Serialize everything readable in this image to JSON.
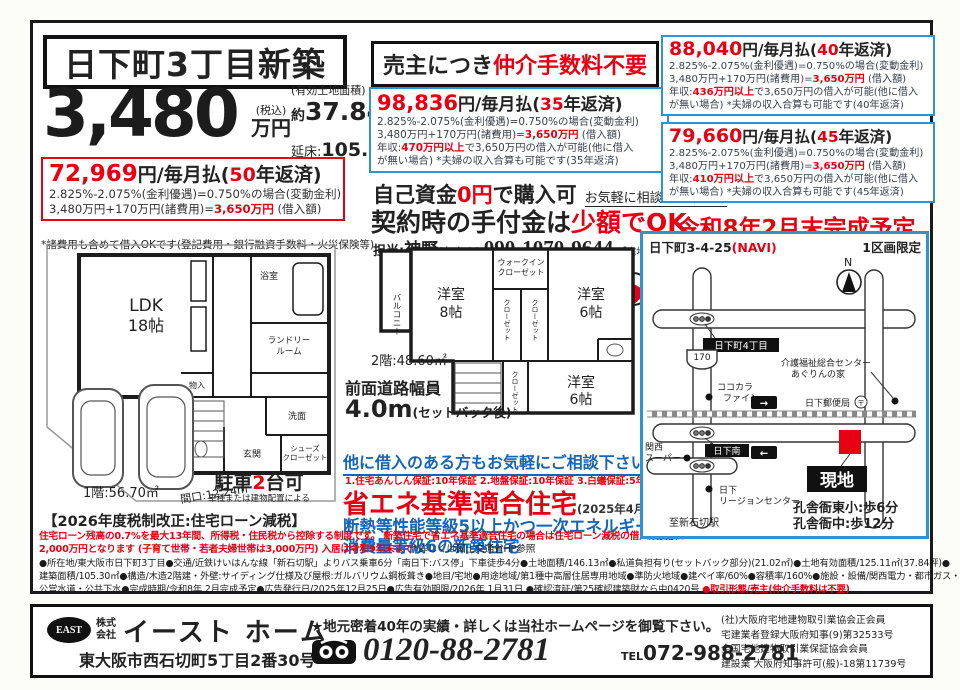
{
  "colors": {
    "red": "#e60012",
    "blue_border": "#2b93d6",
    "blue_text": "#1465b8"
  },
  "title": "日下町3丁目新築",
  "price": {
    "amount": "3,480",
    "tax": "(税込)",
    "unit": "万円",
    "land_label": "(有効土地面積)",
    "land_approx": "約",
    "land_num": "37.84",
    "land_unit": "坪付",
    "floor_label": "延床:",
    "floor_num": "105.30㎡"
  },
  "note_fees": "*諸費用も含めて借入OKです(登記費用・銀行融資手数料・火災保険等)",
  "broker": {
    "black": "売主につき",
    "red": "仲介手数料不要"
  },
  "plans": {
    "p50": {
      "amount": "72,969",
      "unit1": "円/毎月払(",
      "years": "50",
      "unit2": "年返済)",
      "rate": "2.825%-2.075%(金利優遇)=0.750%の場合(変動金利)",
      "sum_pre": "3,480万円+170万円(諸費用)=",
      "sum_hl": "3,650万円",
      "sum_post": " (借入額)"
    },
    "p35": {
      "amount": "98,836",
      "unit1": "円/毎月払(",
      "years": "35",
      "unit2": "年返済)",
      "rate": "2.825%-2.075%(金利優遇)=0.750%の場合(変動金利)",
      "sum_pre": "3,480万円+170万円(諸費用)=",
      "sum_hl": "3,650万円",
      "sum_post": " (借入額)",
      "income_pre": "年収:",
      "income_hl": "470万円以上",
      "income_post": "で3,650万円の借入が可能(他に借入",
      "income_l2": "が無い場合) *夫婦の収入合算も可能です(35年返済)"
    },
    "p40": {
      "amount": "88,040",
      "unit1": "円/毎月払(",
      "years": "40",
      "unit2": "年返済)",
      "rate": "2.825%-2.075%(金利優遇)=0.750%の場合(変動金利)",
      "sum_pre": "3,480万円+170万円(諸費用)=",
      "sum_hl": "3,650万円",
      "sum_post": " (借入額)",
      "income_pre": "年収:",
      "income_hl": "436万円以上",
      "income_post": "で3,650万円の借入が可能(他に借入",
      "income_l2": "が無い場合) *夫婦の収入合算も可能です(40年返済)"
    },
    "p45": {
      "amount": "79,660",
      "unit1": "円/毎月払(",
      "years": "45",
      "unit2": "年返済)",
      "rate": "2.825%-2.075%(金利優遇)=0.750%の場合(変動金利)",
      "sum_pre": "3,480万円+170万円(諸費用)=",
      "sum_hl": "3,650万円",
      "sum_post": " (借入額)",
      "income_pre": "年収:",
      "income_hl": "410万円以上",
      "income_post": "で3,650万円の借入が可能(他に借入",
      "income_l2": "が無い場合) *夫婦の収入合算も可能です(45年返済)"
    }
  },
  "selffund": {
    "pre": "自己資金",
    "hl": "0円",
    "post": "で購入可",
    "note": "お気軽に相談して下さい"
  },
  "deposit": {
    "pre": "契約時の手付金は",
    "hl": "少額でOK"
  },
  "contact": {
    "label": "担当:",
    "name": "神野",
    "kana": "(かんの)",
    "phone": "090-1070-9644",
    "license": "【宅地建物取引士】"
  },
  "completion": "令和8年2月末完成予定",
  "floor1": {
    "ldk1": "LDK",
    "ldk2": "18帖",
    "bath": "浴室",
    "laundry1": "ランドリー",
    "laundry2": "ルーム",
    "wash": "洗面",
    "entrance": "玄関",
    "shoes1": "シューズ",
    "shoes2": "クローゼット",
    "storage": "物入",
    "parking_pre": "駐車",
    "parking_hl": "2",
    "parking_post": "台可",
    "parking_note": "車種または建物配置による",
    "area": "1階:56.70㎡",
    "frontage": "間口:12.24m"
  },
  "floor2": {
    "balcony": "バルコニー",
    "room8a": "洋室",
    "room8b": "8帖",
    "wic1": "ウォークイン",
    "wic2": "クローゼット",
    "cl1": "クローゼット",
    "cl2": "クローゼット",
    "cl3": "クローゼット",
    "room6a1": "洋室",
    "room6a2": "6帖",
    "room6b1": "洋室",
    "room6b2": "6帖",
    "area": "2階:48.60㎡"
  },
  "road": {
    "l1": "前面道路幅員",
    "big": "4.0m",
    "note": "(セットバック後)"
  },
  "consult": {
    "link": "他に借入のある方もお気軽にご相談下さい",
    "warranty": "1.住宅あんしん保証:10年保証 2.地盤保証:10年保証 3.白蟻保証:5年保証",
    "eco": "省エネ基準適合住宅",
    "eco_note": "(2025年4月以降義務化)",
    "blue1": "断熱等性能等級5以上かつ一次エネルギー",
    "blue2": "消費量等級6の新築住宅"
  },
  "tax": {
    "title": "【2026年度税制改正:住宅ローン減税】",
    "red1": "住宅ローン残高の0.7%を最大13年間、所得税・住民税から控除する制度です。 新築住宅で省エネ基準適合住宅の場合は住宅ローン減税の借入限度額は",
    "red2": "2,000万円となります (子育て世帯・若者夫婦世帯は3,000万円) 入居は令和9年末まで",
    "black": "*詳しくは国土交通省HP参照"
  },
  "map": {
    "address": "日下町3-4-25",
    "navi": "(NAVI)",
    "limited": "1区画限定",
    "north": "N",
    "badge_4chome": "日下町4丁目",
    "route": "170",
    "care1": "介護福祉総合センター",
    "care2": "あぐりんの家",
    "cocokara1": "ココカラ",
    "cocokara2": "ファイン",
    "post": "日下郵便局",
    "post_mark": "〒",
    "badge_south": "日下南",
    "kansai1": "関西",
    "kansai2": "スーパー",
    "region1": "日下",
    "region2": "リージョンセンター",
    "station": "至新石切駅",
    "site": "現地",
    "walk1": "孔舎衙東小:歩6分",
    "walk2": "孔舎衙中:歩12分",
    "arrow_r": "→",
    "arrow_l": "←"
  },
  "details": {
    "l1": "●所在地/東大阪市日下町3丁目●交通/近鉄けいはんな線「新石切駅」よりバス乗車6分「南日下:バス停」下車徒歩4分●土地面積/146.13㎡●私道負担有り(セットバック部分)(21.02㎡)●土地有効面積/125.11㎡(37.84坪)●",
    "l2": "建築面積/105.30㎡●構造/木造2階建・外壁:サイディング仕様及び屋根:ガルバリウム鋼板葺き●地目/宅地●用途地域/第1種中高層住居専用地域●準防火地域●建ペイ率/60%●容積率/160%●施設・設備/関西電力・都市ガス・",
    "l3": "公営水道・公共下水●完成時期/令和8年 2月完成予定●広告発行日/2025年12月25日●広告有効期限/2026年 1月31日 ●確認済証/第25確認建築財なら中0420号 ",
    "l3_red": "●取引形態/売主(仲介手数料は不要)"
  },
  "footer": {
    "badge": "EAST",
    "corp1": "株式",
    "corp2": "会社",
    "company": "イースト ホーム",
    "address": "東大阪市西石切町5丁目2番30号",
    "promo": "★地元密着40年の実績・詳しくは当社ホームページを御覧下さい。",
    "freedial": "0120-88-2781",
    "tel_label": "TEL",
    "tel": "072-988-2781",
    "certs": [
      "(社)大阪府宅地建物取引業協会正会員",
      "宅建業者登録大阪府知事(9)第32533号",
      "全国宅地建物取引業保証協会会員",
      "建設業 大阪府知事許可(般)-18第11739号"
    ]
  }
}
